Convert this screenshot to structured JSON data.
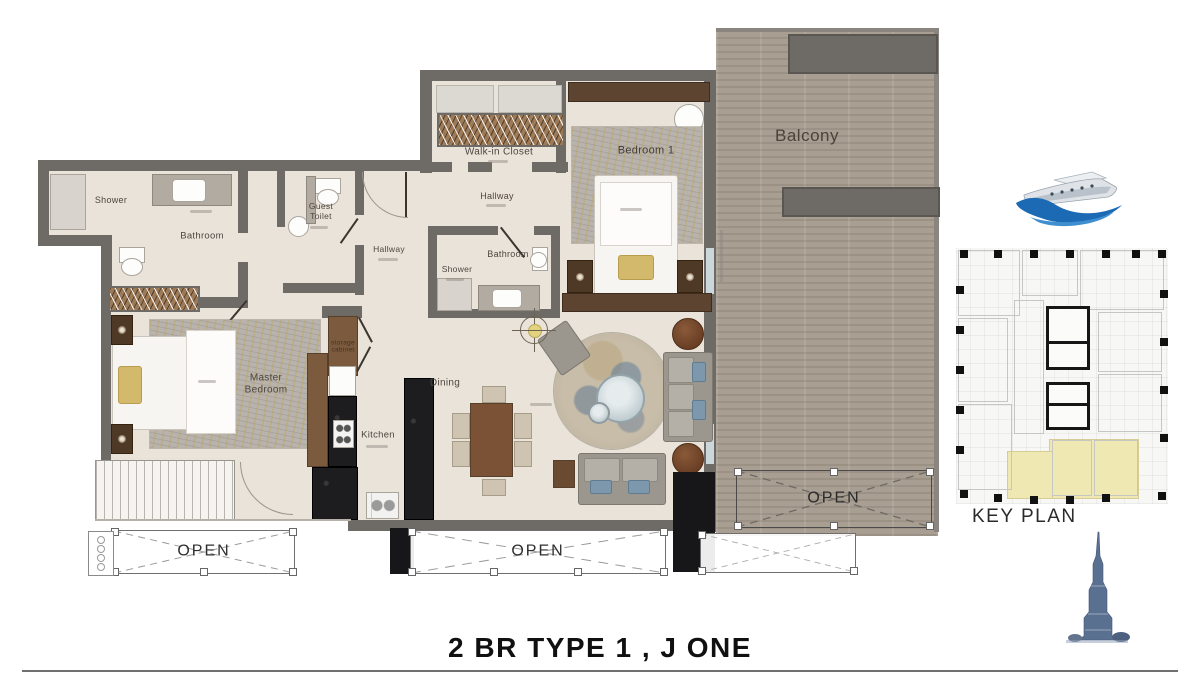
{
  "title": "2 BR TYPE 1 , J ONE",
  "plan": {
    "rooms": {
      "shower1": "Shower",
      "bathroom1": "Bathroom",
      "guest_toilet": "Guest Toilet",
      "walk_in_closet": "Walk-in Closet",
      "hallway_upper": "Hallway",
      "hallway_lower": "Hallway",
      "shower2": "Shower",
      "bathroom2": "Bathroom",
      "bedroom1": "Bedroom 1",
      "balcony": "Balcony",
      "master_bedroom": "Master Bedroom",
      "storage_cabinet": "storage cabinet",
      "kitchen": "Kitchen",
      "dining": "Dining"
    },
    "open_areas": {
      "left": "OPEN",
      "middle": "OPEN",
      "balcony": "OPEN"
    }
  },
  "key_plan": {
    "label": "KEY PLAN",
    "highlight_color": "#efe8b2"
  },
  "icons": {
    "logo": "yacht-logo",
    "tower": "burj-khalifa-tower"
  },
  "colors": {
    "wall": "#6e6a66",
    "floor": "#e9e3da",
    "deck": "#a69c90",
    "accent_blue": "#1c69b4",
    "title_text": "#101010"
  }
}
